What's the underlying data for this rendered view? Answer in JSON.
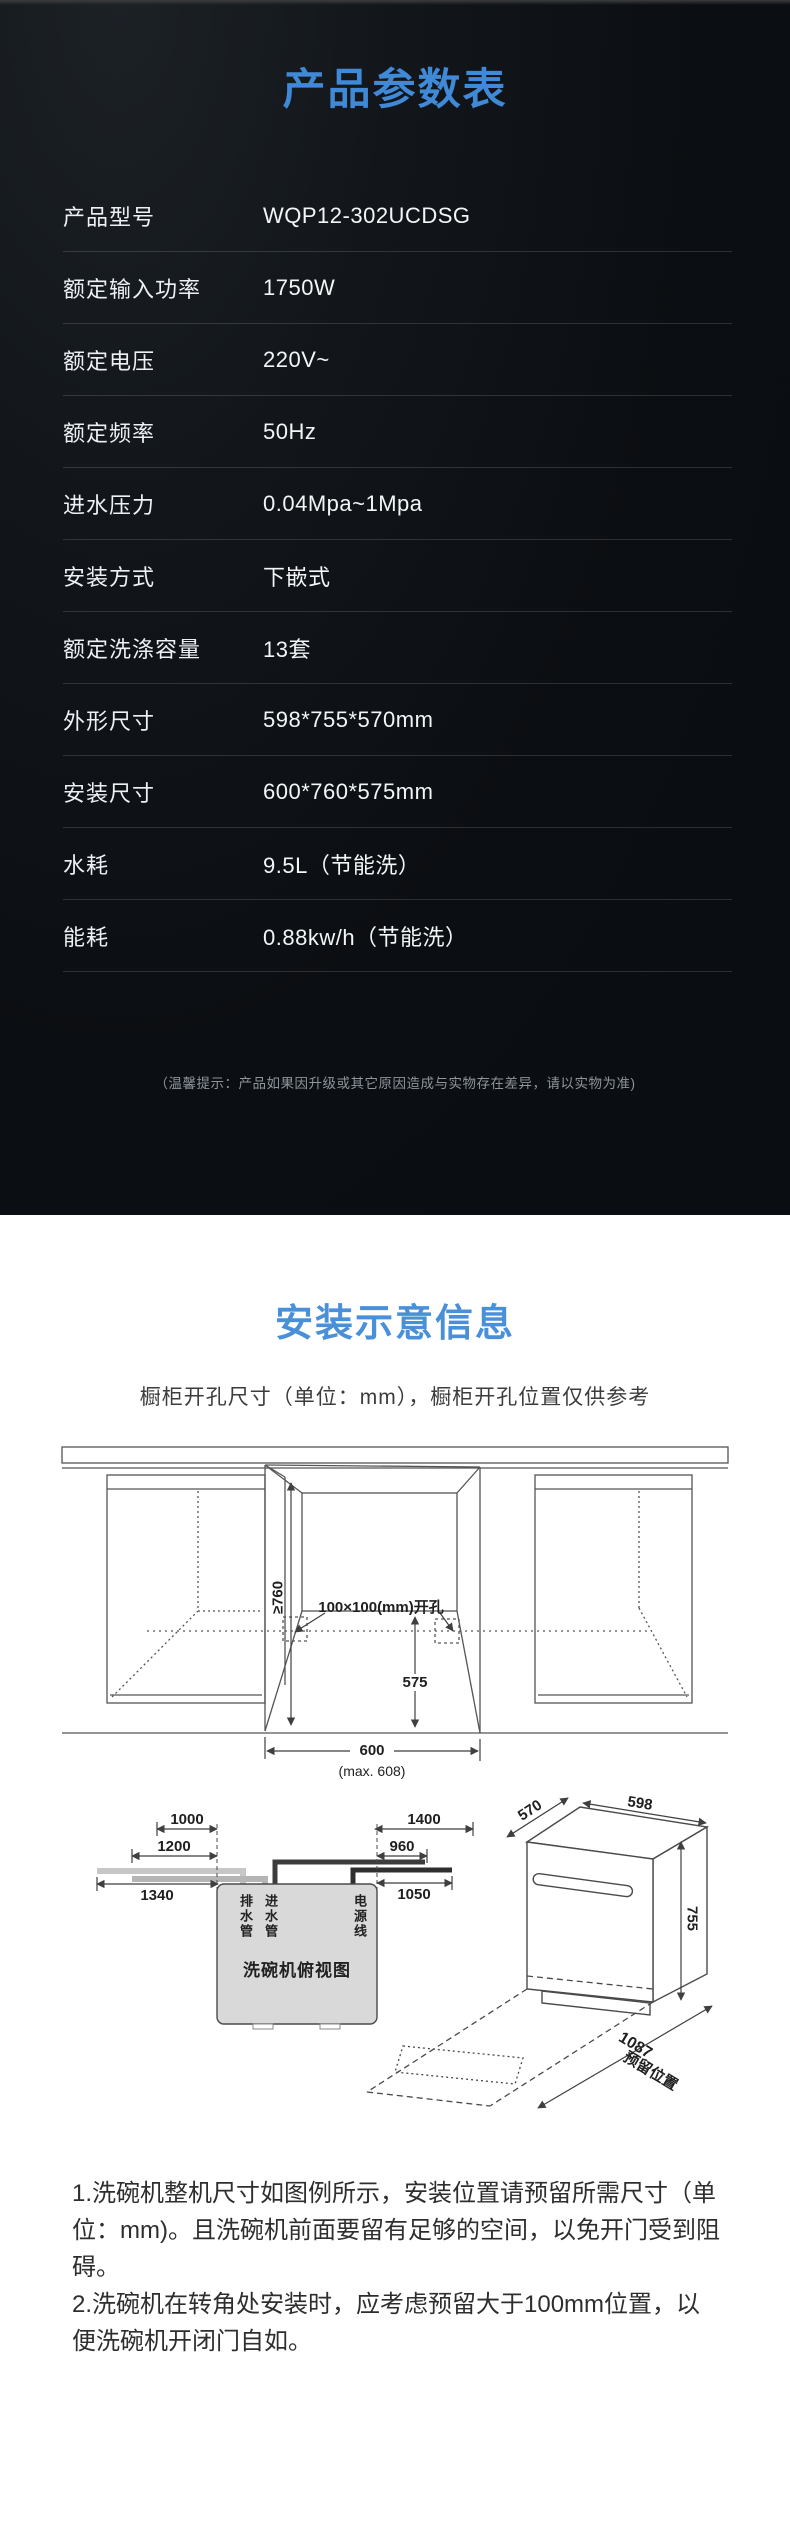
{
  "colors": {
    "accent_blue_dark_section": "#4089d6",
    "accent_blue_light_section": "#4a90d9",
    "dark_background": "#0b0e12",
    "table_text": "#f3f5f7",
    "diagram_line": "#4a4a4a"
  },
  "spec_section": {
    "title": "产品参数表",
    "rows": [
      {
        "label": "产品型号",
        "value": "WQP12-302UCDSG"
      },
      {
        "label": "额定输入功率",
        "value": "1750W"
      },
      {
        "label": "额定电压",
        "value": "220V~"
      },
      {
        "label": "额定频率",
        "value": "50Hz"
      },
      {
        "label": "进水压力",
        "value": "0.04Mpa~1Mpa"
      },
      {
        "label": "安装方式",
        "value": "下嵌式"
      },
      {
        "label": "额定洗涤容量",
        "value": "13套"
      },
      {
        "label": "外形尺寸",
        "value": "598*755*570mm"
      },
      {
        "label": "安装尺寸",
        "value": "600*760*575mm"
      },
      {
        "label": "水耗",
        "value": "9.5L（节能洗）"
      },
      {
        "label": "能耗",
        "value": "0.88kw/h（节能洗）"
      }
    ],
    "disclaimer": "（温馨提示：产品如果因升级或其它原因造成与实物存在差异，请以实物为准)"
  },
  "install_section": {
    "title": "安装示意信息",
    "subtitle": "橱柜开孔尺寸（单位：mm），橱柜开孔位置仅供参考",
    "cabinet_diagram": {
      "dim_height": "≥760",
      "cutout_label": "100×100(mm)开孔",
      "dim_depth": "575",
      "dim_width": "600",
      "dim_width_max": "(max. 608)"
    },
    "topview_diagram": {
      "title": "洗碗机俯视图",
      "drain_label": "排水管",
      "inlet_label": "进水管",
      "power_label": "电源线",
      "dim_left_1": "1000",
      "dim_left_2": "1200",
      "dim_left_3": "1340",
      "dim_right_1": "1400",
      "dim_right_2": "960",
      "dim_right_3": "1050"
    },
    "machine_diagram": {
      "dim_depth": "570",
      "dim_width": "598",
      "dim_height": "755",
      "dim_reserved": "1087",
      "reserved_label": "预留位置"
    },
    "notes": [
      "1.洗碗机整机尺寸如图例所示，安装位置请预留所需尺寸（单位：mm)。且洗碗机前面要留有足够的空间，以免开门受到阻碍。",
      "2.洗碗机在转角处安装时，应考虑预留大于100mm位置，以便洗碗机开闭门自如。"
    ]
  }
}
